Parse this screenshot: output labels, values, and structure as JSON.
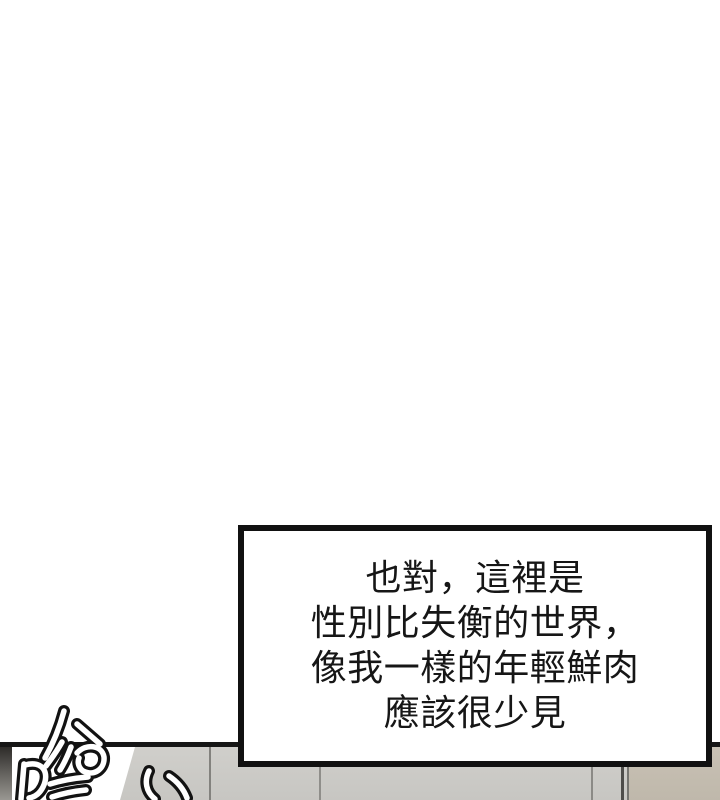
{
  "dialog_box": {
    "lines": [
      "也對，這裡是",
      "性別比失衡的世界，",
      "像我一樣的年輕鮮肉",
      "應該很少見"
    ]
  },
  "sfx": {
    "text": "哈哈"
  },
  "colors": {
    "page_background": "#ffffff",
    "panel_line": "#161616",
    "dialog_border": "#111111",
    "dialog_text": "#161616",
    "wall_gray": "#cbcac7",
    "wall_tan": "#c2bbae",
    "wall_seam_dark": "#4e4d4a",
    "door_edge_dark": "#2e2c29"
  }
}
